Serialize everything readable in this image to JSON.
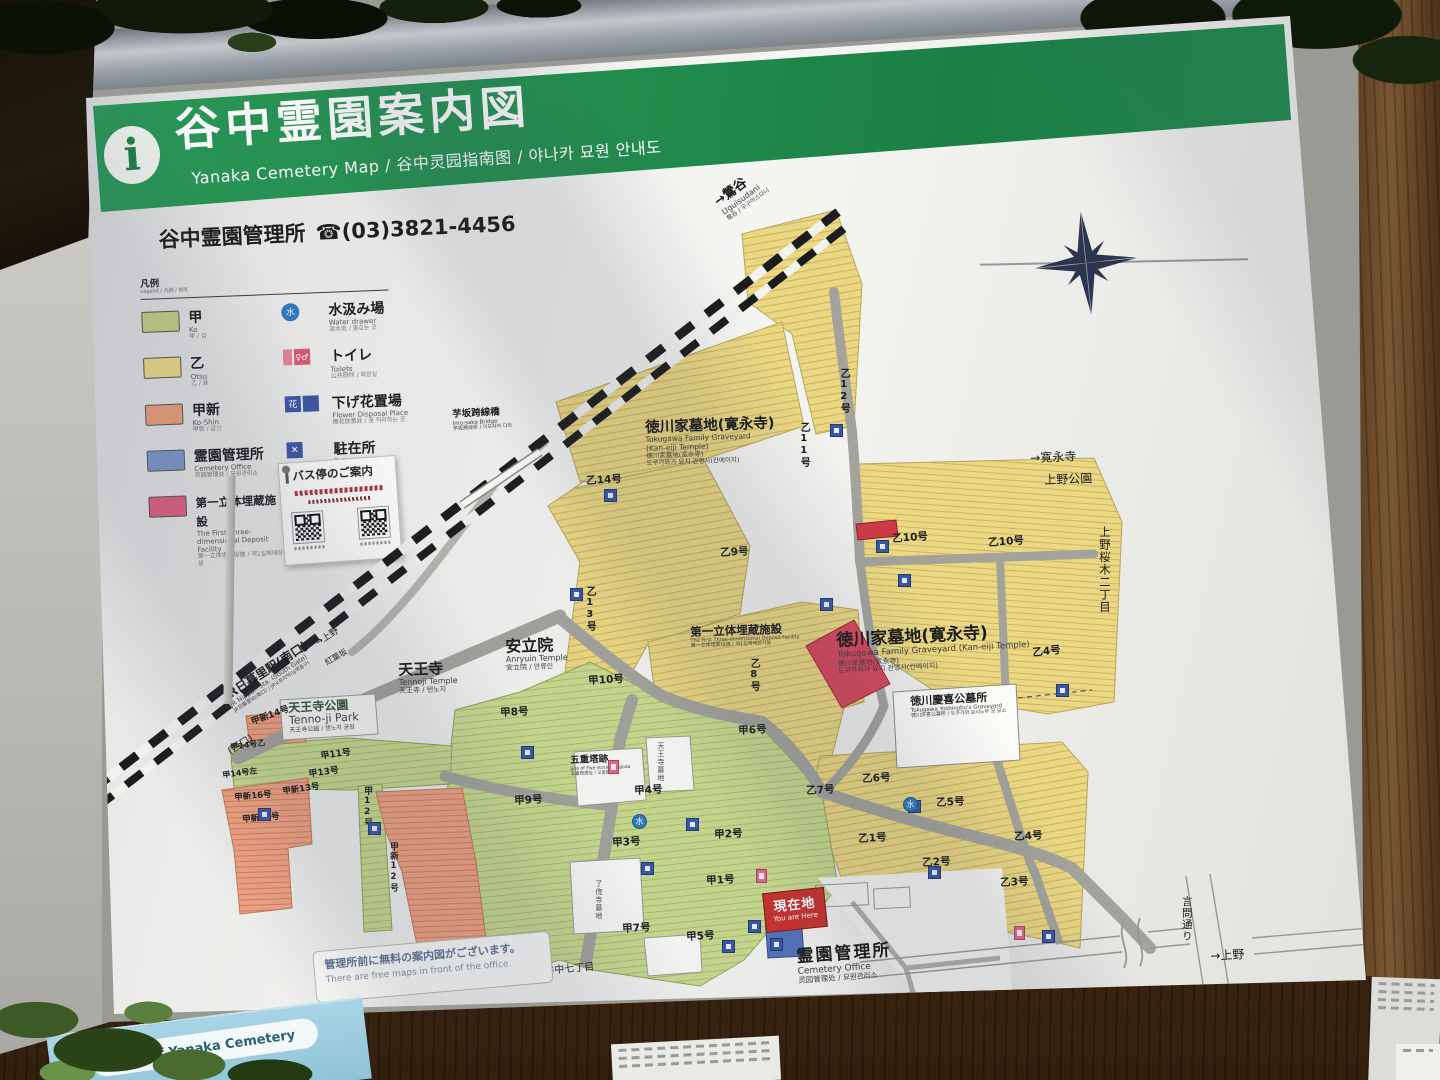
{
  "header": {
    "info_glyph": "i",
    "title": "谷中霊園案内図",
    "subtitle": "Yanaka Cemetery Map / 谷中灵园指南图 / 야나카 묘원 안내도"
  },
  "contact": {
    "office": "谷中霊園管理所",
    "phone": "☎(03)3821-4456"
  },
  "legend": {
    "heading": "凡例",
    "heading_sub": "Legend / 凡例 / 범례",
    "areas": [
      {
        "name": "甲",
        "sub1": "Ko",
        "sub2": "甲 / 갑",
        "color": "#c6d483"
      },
      {
        "name": "乙",
        "sub1": "Otsu",
        "sub2": "乙 / 을",
        "color": "#efdd8a"
      },
      {
        "name": "甲新",
        "sub1": "Ko-Shin",
        "sub2": "甲新 / 갑신",
        "color": "#efa07b"
      },
      {
        "name": "霊園管理所",
        "sub1": "Cemetery Office",
        "sub2": "灵园管理处 / 묘원관리소",
        "color": "#7e97cb"
      },
      {
        "name": "第一立体埋蔵施設",
        "sub1": "The First Three-dimensional Deposit Facility",
        "sub2": "第一立体埋葬设施 / 제1입체매장시설",
        "color": "#e16180"
      }
    ],
    "facilities": [
      {
        "name": "水汲み場",
        "sub1": "Water drawer",
        "sub2": "汲水处 / 물긷는 곳",
        "icon": "water"
      },
      {
        "name": "トイレ",
        "sub1": "Toilets",
        "sub2": "公共厕所 / 화장실",
        "icon": "toilet"
      },
      {
        "name": "下げ花置場",
        "sub1": "Flower Disposal Place",
        "sub2": "佛花放置处 / 꽃 처리하는 곳",
        "icon": "flower"
      },
      {
        "name": "駐在所",
        "sub1": "Police Box",
        "sub2": "办事处 / 주재소",
        "icon": "police"
      }
    ]
  },
  "bus_box": {
    "title": "バス停のご案内"
  },
  "you_are_here": {
    "jp": "現在地",
    "en": "You are Here"
  },
  "note": {
    "jp": "管理所前に無料の案内図がございます。",
    "en": "There are free maps in front of the office."
  },
  "mini_sign": {
    "label": "Map of Yanaka Cemetery"
  },
  "map": {
    "labels": [
      {
        "t": "→鶯谷",
        "x": 712,
        "y": 198,
        "fs": 13,
        "rot": -36,
        "w": 700,
        "sub": [
          {
            "t": "Uguisudani",
            "fs": 8
          },
          {
            "t": "莺谷 / 우구이스다니",
            "fs": 6
          }
        ]
      },
      {
        "t": "芋坂跨線橋",
        "x": 452,
        "y": 410,
        "fs": 9.5,
        "w": 700,
        "rot": -3,
        "sub": [
          {
            "t": "Imo-saka Bridge",
            "fs": 5.5
          },
          {
            "t": "芋坂跨线桥 / 이모자카 다리",
            "fs": 5
          }
        ]
      },
      {
        "t": "徳川家墓地(寛永寺)",
        "x": 645,
        "y": 420,
        "fs": 14.5,
        "w": 700,
        "rot": -2,
        "sub": [
          {
            "t": "Tokugawa Family Graveyard",
            "fs": 7.5
          },
          {
            "t": "(Kan-eiji Temple)",
            "fs": 7.5
          },
          {
            "t": "德川家墓地(宽永寺)",
            "fs": 6.5
          },
          {
            "t": "도쿠가와가 묘지 관영사(칸에이지)",
            "fs": 6.5
          }
        ]
      },
      {
        "t": "徳川家墓地(寛永寺)",
        "x": 836,
        "y": 632,
        "fs": 17,
        "w": 700,
        "rot": -3,
        "sub": [
          {
            "t": "Tokugawa Family Graveyard (Kan-eiji Temple)",
            "fs": 8.5
          },
          {
            "t": "德川家墓地(宽永寺)",
            "fs": 7
          },
          {
            "t": "도쿠가와가 묘지 관영사(칸에이지)",
            "fs": 7
          }
        ]
      },
      {
        "t": "徳川慶喜公墓所",
        "x": 910,
        "y": 696,
        "fs": 11,
        "w": 700,
        "rot": -3,
        "sub": [
          {
            "t": "Tokugawa Yoshinobu's Graveyard",
            "fs": 5.5
          },
          {
            "t": "德川庆喜公墓所 / 도쿠가와 요시노부 공 묘소",
            "fs": 5
          }
        ]
      },
      {
        "t": "安立院",
        "x": 505,
        "y": 638,
        "fs": 16,
        "w": 700,
        "rot": -2,
        "sub": [
          {
            "t": "Anryuin Temple",
            "fs": 8
          },
          {
            "t": "安立院 / 안류인",
            "fs": 7
          }
        ]
      },
      {
        "t": "天王寺",
        "x": 398,
        "y": 662,
        "fs": 15,
        "w": 700,
        "rot": -2,
        "sub": [
          {
            "t": "Tennoji Temple",
            "fs": 8
          },
          {
            "t": "天王寺 / 텐노지",
            "fs": 7
          }
        ]
      },
      {
        "t": "天王寺公園",
        "x": 288,
        "y": 702,
        "fs": 12,
        "w": 700,
        "c": "#2e5233",
        "rot": -3,
        "sub": [
          {
            "t": "Tenno-ji Park",
            "fs": 11
          },
          {
            "t": "天王寺公园 / 텐노지 공원",
            "fs": 6
          }
        ]
      },
      {
        "t": "五重塔跡",
        "x": 570,
        "y": 756,
        "fs": 9.5,
        "w": 700,
        "rot": -2,
        "sub": [
          {
            "t": "Site of Five-storied Pagoda",
            "fs": 4.5
          },
          {
            "t": "五重塔遗址 / 오층탑 터",
            "fs": 4.5
          }
        ]
      },
      {
        "t": "霊園管理所",
        "x": 796,
        "y": 948,
        "fs": 17,
        "w": 700,
        "rot": -4,
        "ls": 2,
        "sub": [
          {
            "t": "Cemetery Office",
            "fs": 9
          },
          {
            "t": "灵园管理处 / 묘원관리소",
            "fs": 7.5
          }
        ]
      },
      {
        "t": "第一立体埋蔵施設",
        "x": 690,
        "y": 626,
        "fs": 11.5,
        "w": 700,
        "rot": -2,
        "sub": [
          {
            "t": "The First Three-dimensional Deposit Facility",
            "fs": 5
          },
          {
            "t": "第一立体埋葬设施 / 제1입체매장시설",
            "fs": 5
          }
        ]
      },
      {
        "t": "JR日暮里駅(南口)",
        "x": 222,
        "y": 692,
        "fs": 12,
        "w": 700,
        "rot": -33,
        "sub": [
          {
            "t": "JR Nippori Sta. (South Gate)",
            "fs": 6.5
          },
          {
            "t": "JR日暮里站(南口) / JR닛포리역(남쪽출구)",
            "fs": 5
          }
        ]
      },
      {
        "t": "(西口)",
        "x": 226,
        "y": 748,
        "fs": 10,
        "rot": -33
      },
      {
        "t": "←池袋",
        "x": 28,
        "y": 766,
        "fs": 11,
        "rot": -33,
        "sub": [
          {
            "t": "Ikebukuro",
            "fs": 6
          },
          {
            "t": "池袋 / 이케부쿠로",
            "fs": 5
          }
        ]
      },
      {
        "t": "紅葉坂",
        "x": 324,
        "y": 660,
        "fs": 8,
        "rot": -30
      },
      {
        "t": "→上野",
        "x": 314,
        "y": 640,
        "fs": 9,
        "rot": -33
      },
      {
        "t": "→寛永寺",
        "x": 1030,
        "y": 452,
        "fs": 12,
        "rot": -2
      },
      {
        "t": "上野公園",
        "x": 1044,
        "y": 474,
        "fs": 12,
        "rot": -2
      },
      {
        "t": "上野桜木二丁目",
        "x": 1098,
        "y": 526,
        "fs": 11.5,
        "v": true
      },
      {
        "t": "言問通り",
        "x": 1180,
        "y": 896,
        "fs": 10.5,
        "v": true
      },
      {
        "t": "→上野",
        "x": 1210,
        "y": 950,
        "fs": 12,
        "rot": -3
      },
      {
        "t": "谷中七丁目",
        "x": 544,
        "y": 966,
        "fs": 10,
        "rot": -5
      },
      {
        "t": "谷中七丁目",
        "x": 1076,
        "y": 1030,
        "fs": 10,
        "rot": -2
      },
      {
        "t": "乙14号",
        "x": 586,
        "y": 476,
        "fs": 10.5,
        "w": 600,
        "rot": -3
      },
      {
        "t": "乙13号",
        "x": 584,
        "y": 586,
        "fs": 10,
        "w": 600,
        "v": true
      },
      {
        "t": "乙12号",
        "x": 838,
        "y": 368,
        "fs": 10,
        "w": 600,
        "v": true
      },
      {
        "t": "乙11号",
        "x": 798,
        "y": 422,
        "fs": 10,
        "w": 600,
        "v": true
      },
      {
        "t": "乙9号",
        "x": 720,
        "y": 548,
        "fs": 10.5,
        "w": 600,
        "rot": -3
      },
      {
        "t": "乙10号",
        "x": 892,
        "y": 534,
        "fs": 10.5,
        "w": 600,
        "rot": -4
      },
      {
        "t": "乙10号",
        "x": 988,
        "y": 538,
        "fs": 10.5,
        "w": 600,
        "rot": -4
      },
      {
        "t": "乙8号",
        "x": 748,
        "y": 658,
        "fs": 10,
        "w": 600,
        "v": true
      },
      {
        "t": "乙4号",
        "x": 1032,
        "y": 648,
        "fs": 10.5,
        "w": 600,
        "rot": -6
      },
      {
        "t": "乙7号",
        "x": 806,
        "y": 786,
        "fs": 10.5,
        "w": 600,
        "rot": -3
      },
      {
        "t": "乙6号",
        "x": 862,
        "y": 774,
        "fs": 10.5,
        "w": 600,
        "rot": -3
      },
      {
        "t": "乙5号",
        "x": 936,
        "y": 798,
        "fs": 10.5,
        "w": 600,
        "rot": -3
      },
      {
        "t": "乙1号",
        "x": 858,
        "y": 834,
        "fs": 10.5,
        "w": 600,
        "rot": -3
      },
      {
        "t": "乙2号",
        "x": 922,
        "y": 858,
        "fs": 10.5,
        "w": 600,
        "rot": -3
      },
      {
        "t": "乙4号",
        "x": 1014,
        "y": 832,
        "fs": 10.5,
        "w": 600,
        "rot": -3
      },
      {
        "t": "乙3号",
        "x": 1000,
        "y": 878,
        "fs": 10.5,
        "w": 600,
        "rot": -3
      },
      {
        "t": "甲10号",
        "x": 588,
        "y": 676,
        "fs": 10.5,
        "w": 600,
        "rot": -3
      },
      {
        "t": "甲8号",
        "x": 500,
        "y": 708,
        "fs": 10.5,
        "w": 600,
        "rot": -3
      },
      {
        "t": "甲6号",
        "x": 738,
        "y": 726,
        "fs": 10.5,
        "w": 600,
        "rot": -3
      },
      {
        "t": "甲9号",
        "x": 514,
        "y": 796,
        "fs": 10.5,
        "w": 600,
        "rot": -3
      },
      {
        "t": "甲4号",
        "x": 634,
        "y": 786,
        "fs": 10.5,
        "w": 600,
        "rot": -3
      },
      {
        "t": "甲2号",
        "x": 714,
        "y": 830,
        "fs": 10.5,
        "w": 600,
        "rot": -3
      },
      {
        "t": "甲3号",
        "x": 612,
        "y": 838,
        "fs": 10.5,
        "w": 600,
        "rot": -3
      },
      {
        "t": "甲1号",
        "x": 706,
        "y": 876,
        "fs": 10.5,
        "w": 600,
        "rot": -3
      },
      {
        "t": "甲7号",
        "x": 622,
        "y": 924,
        "fs": 10.5,
        "w": 600,
        "rot": -3
      },
      {
        "t": "甲5号",
        "x": 686,
        "y": 932,
        "fs": 10.5,
        "w": 600,
        "rot": -3
      },
      {
        "t": "甲新14号",
        "x": 250,
        "y": 718,
        "fs": 9,
        "w": 600,
        "rot": -20
      },
      {
        "t": "甲14号乙",
        "x": 230,
        "y": 744,
        "fs": 8,
        "w": 600,
        "rot": -8
      },
      {
        "t": "甲11号",
        "x": 320,
        "y": 752,
        "fs": 9,
        "w": 600,
        "rot": -8
      },
      {
        "t": "甲13号",
        "x": 308,
        "y": 770,
        "fs": 9,
        "w": 600,
        "rot": -8
      },
      {
        "t": "甲14号左",
        "x": 222,
        "y": 772,
        "fs": 8,
        "w": 600,
        "rot": -8
      },
      {
        "t": "甲新16号",
        "x": 234,
        "y": 794,
        "fs": 8.5,
        "w": 600,
        "rot": -5
      },
      {
        "t": "甲新15号",
        "x": 242,
        "y": 816,
        "fs": 8.5,
        "w": 600,
        "rot": -5
      },
      {
        "t": "甲新13号",
        "x": 282,
        "y": 788,
        "fs": 8.5,
        "w": 600,
        "rot": -8
      },
      {
        "t": "甲12号",
        "x": 362,
        "y": 786,
        "fs": 9,
        "w": 600,
        "v": true
      },
      {
        "t": "甲新12号",
        "x": 388,
        "y": 842,
        "fs": 8.5,
        "w": 600,
        "v": true
      },
      {
        "t": "天王寺墓地",
        "x": 656,
        "y": 742,
        "fs": 7,
        "v": true,
        "c": "#444"
      },
      {
        "t": "了俒寺墓地",
        "x": 594,
        "y": 880,
        "fs": 7,
        "v": true,
        "c": "#444"
      }
    ],
    "icons": [
      {
        "x": 604,
        "y": 489,
        "k": "b"
      },
      {
        "x": 570,
        "y": 588,
        "k": "b"
      },
      {
        "x": 830,
        "y": 424,
        "k": "b"
      },
      {
        "x": 876,
        "y": 540,
        "k": "b"
      },
      {
        "x": 898,
        "y": 574,
        "k": "b"
      },
      {
        "x": 1056,
        "y": 684,
        "k": "b"
      },
      {
        "x": 686,
        "y": 818,
        "k": "b"
      },
      {
        "x": 641,
        "y": 862,
        "k": "b"
      },
      {
        "x": 722,
        "y": 940,
        "k": "b"
      },
      {
        "x": 521,
        "y": 746,
        "k": "b"
      },
      {
        "x": 368,
        "y": 822,
        "k": "b"
      },
      {
        "x": 258,
        "y": 808,
        "k": "b"
      },
      {
        "x": 908,
        "y": 800,
        "k": "b"
      },
      {
        "x": 928,
        "y": 866,
        "k": "b"
      },
      {
        "x": 1042,
        "y": 930,
        "k": "b"
      },
      {
        "x": 770,
        "y": 938,
        "k": "b"
      },
      {
        "x": 748,
        "y": 920,
        "k": "b"
      },
      {
        "x": 820,
        "y": 598,
        "k": "b"
      },
      {
        "x": 608,
        "y": 760,
        "k": "p"
      },
      {
        "x": 756,
        "y": 869,
        "k": "p"
      },
      {
        "x": 1014,
        "y": 926,
        "k": "p"
      },
      {
        "x": 632,
        "y": 814,
        "k": "w"
      },
      {
        "x": 903,
        "y": 797,
        "k": "w"
      }
    ],
    "icon_water_glyph": "水",
    "legend_toilet_glyph": "♀♂",
    "legend_flower_glyph": "花",
    "legend_police_glyph": "×"
  }
}
